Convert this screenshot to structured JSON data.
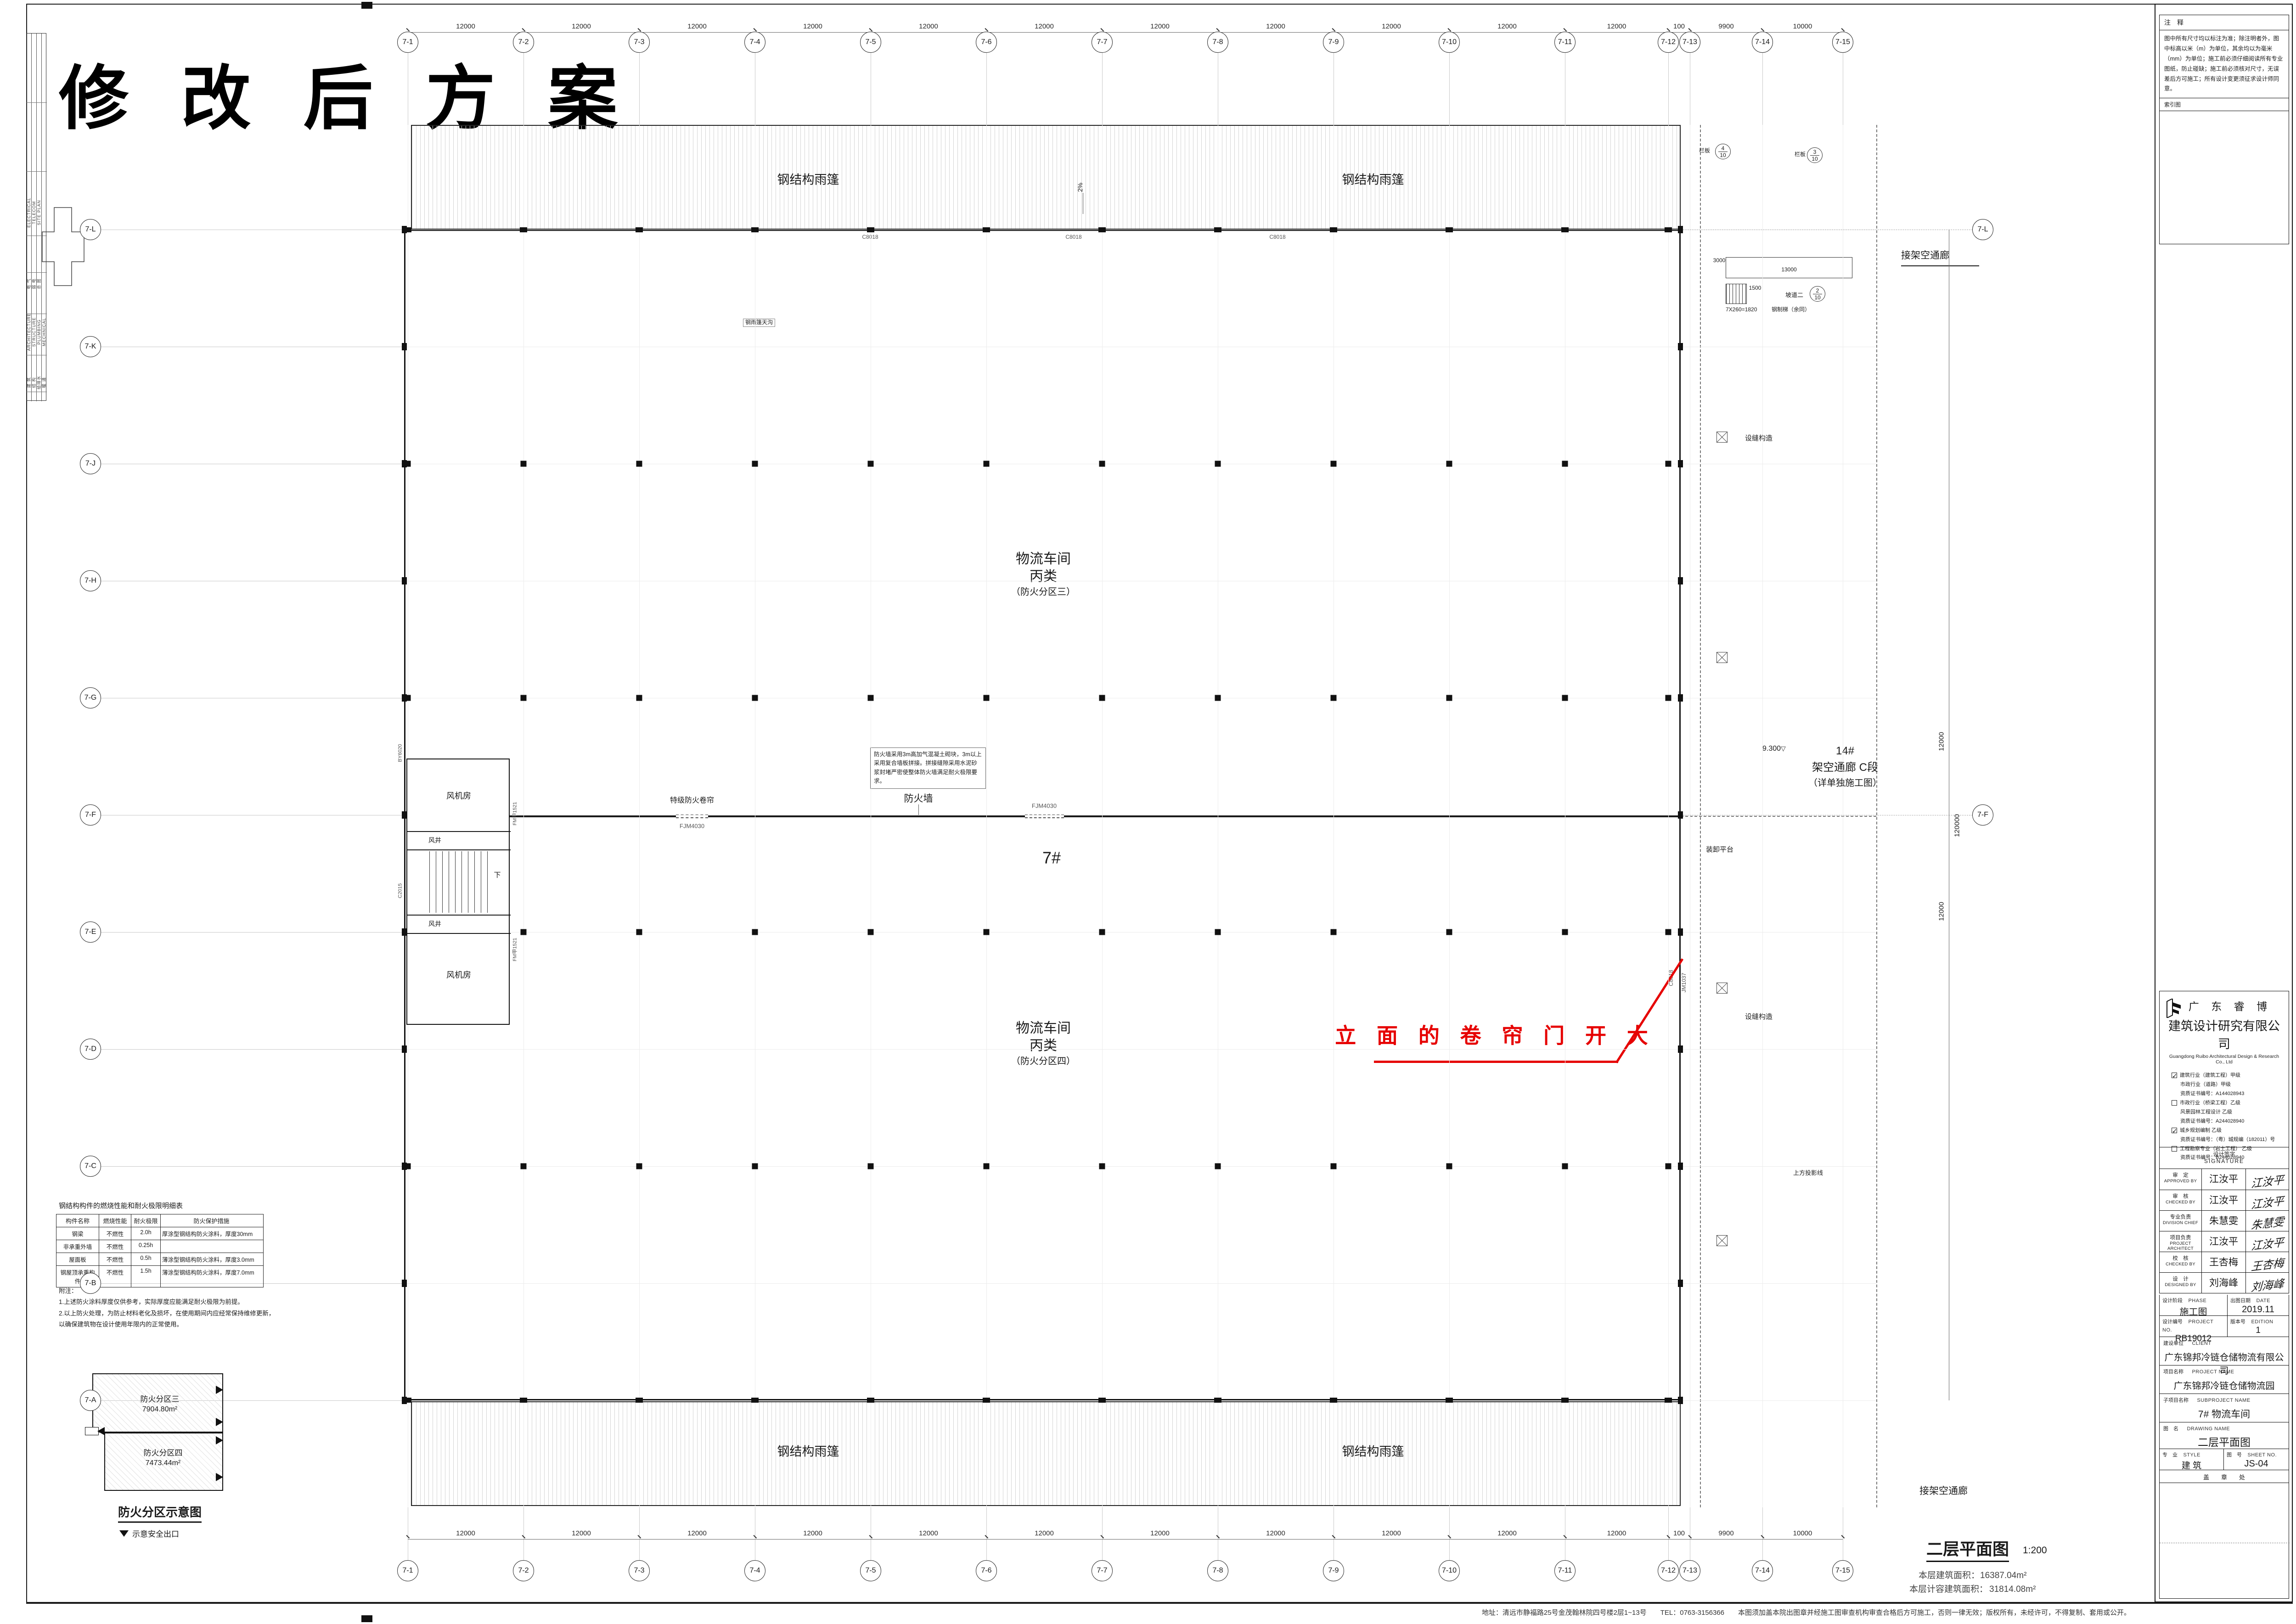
{
  "banner": {
    "title": "修 改 后 方 案"
  },
  "side_strip": {
    "cols": [
      {
        "top_en": "ELECTRICAL",
        "top_cn": "电 气",
        "bot_en": "ARCHITECTURE",
        "bot_cn": "建 筑"
      },
      {
        "top_en": "TELECOM",
        "top_cn": "弱 电",
        "bot_en": "STRUCTURE",
        "bot_cn": "结 构"
      },
      {
        "top_en": "SITE PLAN",
        "top_cn": "总 图",
        "bot_en": "PLUMBING",
        "bot_cn": "给排水"
      },
      {
        "top_en": "",
        "top_cn": "",
        "bot_en": "MECHNICAL",
        "bot_cn": "暖 通"
      }
    ]
  },
  "plan": {
    "building_no": "7#",
    "grid_top": [
      "7-1",
      "7-2",
      "7-3",
      "7-4",
      "7-5",
      "7-6",
      "7-7",
      "7-8",
      "7-9",
      "7-10",
      "7-11",
      "7-12",
      "7-13",
      "7-14",
      "7-15"
    ],
    "grid_left": [
      "7-L",
      "7-K",
      "7-J",
      "7-H",
      "7-G",
      "7-F",
      "7-E",
      "7-D",
      "7-C",
      "7-B",
      "7-A"
    ],
    "grid_right": [
      "7-L",
      "7-F"
    ],
    "dims_top": [
      "12000",
      "12000",
      "12000",
      "12000",
      "12000",
      "12000",
      "12000",
      "12000",
      "12000",
      "12000",
      "12000",
      "100",
      "9900",
      "10000"
    ],
    "dims_right": [
      "12000",
      "120000",
      "12000"
    ],
    "zone_upper": {
      "l1": "物流车间",
      "l2": "丙类",
      "l3": "（防火分区三）"
    },
    "zone_lower": {
      "l1": "物流车间",
      "l2": "丙类",
      "l3": "（防火分区四）"
    },
    "firewall": {
      "label": "防火墙",
      "note": "防火墙采用3m高加气混凝土砌块，3m以上采用复合墙板拼接。拼接缝隙采用水泥砂浆封堵严密使整体防火墙满足耐火极限要求。",
      "door": "FJM4030",
      "shutter": "特级防火卷帘"
    },
    "canopy": {
      "label": "钢结构雨篷",
      "slope": "2%",
      "gutter": "钢雨篷天沟",
      "window": "C8018"
    },
    "east_wall": {
      "win": "C8018",
      "door": "JM1037"
    },
    "stair": {
      "fan": "风机房",
      "shaft": "风井",
      "down": "下",
      "door": "FM甲1521",
      "win_w": "C2015",
      "win_n": "BY6020"
    },
    "corridor": {
      "l1": "14#",
      "l2": "架空通廊 C段",
      "l3": "（详单独施工图）",
      "elev": "9.300",
      "proj": "上方投影线",
      "connect": "接架空通廊",
      "seam": "设缝构造",
      "platform": "装卸平台"
    },
    "ramp": {
      "name": "坡道二",
      "panel": "栏板",
      "d1": "3000",
      "d2": "13000",
      "d3": "1500",
      "steps": "7X260=1820",
      "steps_note": "钢制梯（余同）",
      "det_top": [
        {
          "n": "4",
          "d": "10"
        },
        {
          "n": "3",
          "d": "10"
        }
      ],
      "det_ramp": {
        "n": "2",
        "d": "10"
      }
    },
    "red": {
      "text": "立 面 的 卷 帘 门 开 大"
    }
  },
  "fire_table": {
    "title": "钢结构构件的燃烧性能和耐火极限明细表",
    "headers": [
      "构件名称",
      "燃烧性能",
      "耐火极限",
      "防火保护措施"
    ],
    "rows": [
      [
        "钢梁",
        "不燃性",
        "2.0h",
        "厚涂型钢结构防火涂料，厚度30mm"
      ],
      [
        "非承重外墙",
        "不燃性",
        "0.25h",
        ""
      ],
      [
        "屋面板",
        "不燃性",
        "0.5h",
        "薄涂型钢结构防火涂料，厚度3.0mm"
      ],
      [
        "钢屋顶承重构件",
        "不燃性",
        "1.5h",
        "薄涂型钢结构防火涂料，厚度7.0mm"
      ]
    ],
    "notes": [
      "附注：",
      "1.上述防火涂料厚度仅供参考，实际厚度应能满足耐火极限为前提。",
      "2.以上防火处理，为防止材料老化及损坏，在使用期间内应经常保持维修更新，",
      "以确保建筑物在设计使用年限内的正常使用。"
    ]
  },
  "fire_diagram": {
    "title": "防火分区示意图",
    "legend": "示意安全出口",
    "zone3": "防火分区三",
    "area3": "7904.80m²",
    "zone4": "防火分区四",
    "area4": "7473.44m²"
  },
  "drawing_title": {
    "name": "二层平面图",
    "scale": "1:200",
    "area1_label": "本层建筑面积：",
    "area1_value": "16387.04m²",
    "area2_label": "本层计容建筑面积：",
    "area2_value": "31814.08m²"
  },
  "notes_box": {
    "title": "注　释",
    "body": "图中所有尺寸均以标注为准；除注明者外，图中标高以米（m）为单位，其余均以为毫米（mm）为单位；施工前必须仔细阅读所有专业图纸，防止碰缺；施工前必须核对尺寸，无误差后方可施工；所有设计变更须征求设计师同意。",
    "index_label": "索引图"
  },
  "titleblock": {
    "brand": "广 东 睿 博",
    "company_cn": "建筑设计研究有限公司",
    "company_en": "Guangdong Ruibo Architectural Design & Research Co., Ltd",
    "quals": [
      {
        "box": "checked",
        "text": "建筑行业（建筑工程）甲级"
      },
      {
        "box": "none",
        "text": "市政行业（道路）甲级"
      },
      {
        "box": "none",
        "text": "资质证书编号：A144028943"
      },
      {
        "box": "empty",
        "text": "市政行业（桥梁工程）乙级"
      },
      {
        "box": "none",
        "text": "风景园林工程设计 乙级"
      },
      {
        "box": "none",
        "text": "资质证书编号：A244028940"
      },
      {
        "box": "checked",
        "text": "城乡规划编制 乙级"
      },
      {
        "box": "none",
        "text": "资质证书编号：（粤）城规编（182011）号"
      },
      {
        "box": "empty",
        "text": "工程勘察专业（岩土工程） 乙级"
      },
      {
        "box": "none",
        "text": "资质证书编号：B244028940"
      }
    ],
    "signature_cn": "设计签字",
    "signature_en": "SIGNATURE",
    "sign_rows": [
      {
        "role_cn": "审　定",
        "role_en": "APPROVED BY",
        "name": "江汝平"
      },
      {
        "role_cn": "审　核",
        "role_en": "CHECKED BY",
        "name": "江汝平"
      },
      {
        "role_cn": "专业负责",
        "role_en": "DIVISION CHIEF",
        "name": "朱慧雯"
      },
      {
        "role_cn": "项目负责",
        "role_en": "PROJECT ARCHITECT",
        "name": "江汝平"
      },
      {
        "role_cn": "校　核",
        "role_en": "CHECKED BY",
        "name": "王杏梅"
      },
      {
        "role_cn": "设　计",
        "role_en": "DESIGNED BY",
        "name": "刘海峰"
      }
    ],
    "phase_cn": "设计阶段",
    "phase_en": "PHASE",
    "phase_value": "施工图",
    "date_cn": "出图日期",
    "date_en": "DATE",
    "date_value": "2019.11",
    "projno_cn": "设计编号",
    "projno_en": "PROJECT NO.",
    "projno_value": "RB19012",
    "edition_cn": "版本号",
    "edition_en": "EDITION",
    "edition_value": "1",
    "client_cn": "建设单位",
    "client_en": "CLIENT",
    "client_value": "广东锦邦冷链仓储物流有限公司",
    "project_cn": "项目名称",
    "project_en": "PROJECT NAME",
    "project_value": "广东锦邦冷链仓储物流园",
    "sub_cn": "子项目名称",
    "sub_en": "SUBPROJECT NAME",
    "sub_value": "7# 物流车间",
    "dwg_cn": "图　名",
    "dwg_en": "DRAWING NAME",
    "dwg_value": "二层平面图",
    "style_cn": "专　业",
    "style_en": "STYLE",
    "style_value": "建 筑",
    "sheet_cn": "图　号",
    "sheet_en": "SHEET NO.",
    "sheet_value": "JS-04",
    "stamp": "盖　　章　　处"
  },
  "footer": {
    "text": "地址：清远市静福路25号金茂翰林院四号楼2层1~13号　　TEL：0763-3156366　　本图须加盖本院出图章并经施工图审查机构审查合格后方可施工，否则一律无效；版权所有，未经许可，不得复制、套用或公开。"
  }
}
